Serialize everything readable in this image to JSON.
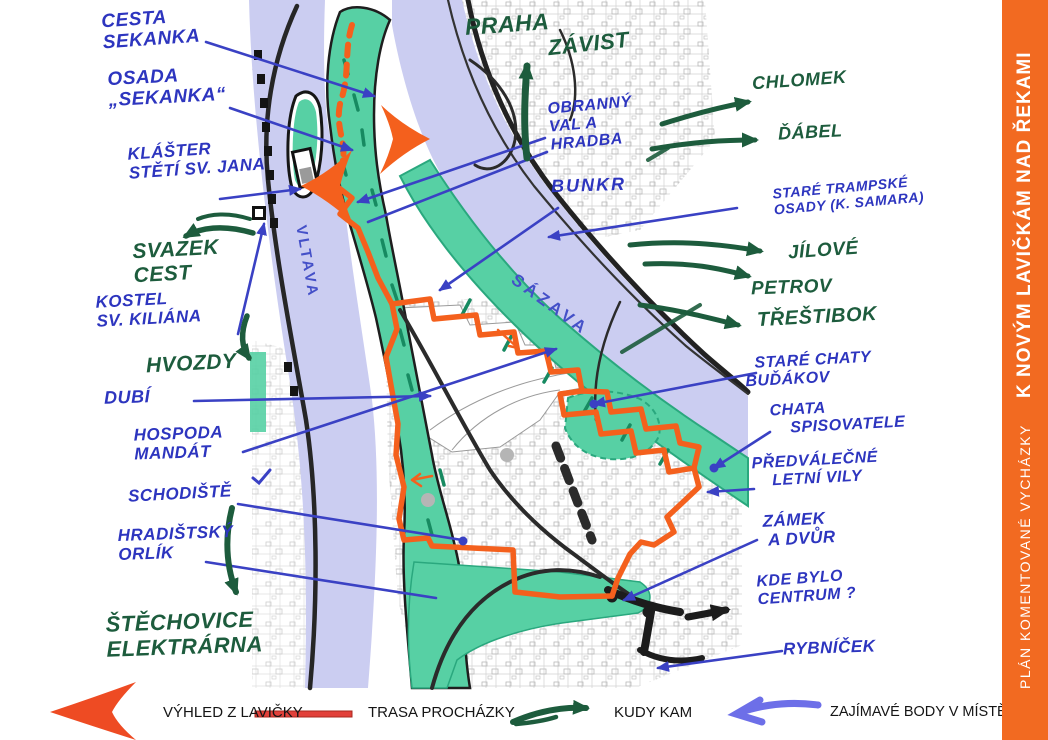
{
  "page": {
    "background": "#ffffff"
  },
  "sidebar": {
    "bg_color": "#f26a21",
    "subtitle": "PLÁN KOMENTOVANÉ VYCHÁZKY",
    "title": "K NOVÝM LAVIČKÁM NAD ŘEKAMI"
  },
  "map": {
    "rivers": {
      "vltava": "VLTAVA",
      "sazava": "SÁZAVA"
    },
    "colors": {
      "river": "#cbcdf1",
      "bank_green": "#57d0a4",
      "bank_dark_green": "#178a61",
      "route_orange": "#f4601d",
      "annotation_blue": "#2d35bf",
      "annotation_green": "#1d5c3d",
      "legend_red": "#e2403a",
      "legend_blue": "#6d6fe8",
      "road_black": "#232323"
    }
  },
  "annotations_blue": {
    "cesta_sekanka": "CESTA\nSEKANKA",
    "osada_sekanka": "OSADA\n„SEKANKA“",
    "klaster": "KLÁŠTER\nSTĚTÍ SV. JANA",
    "kostel": "KOSTEL\nSV. KILIÁNA",
    "dubi": "DUBÍ",
    "hospoda_mandat": "HOSPODA\nMANDÁT",
    "schodiste": "SCHODIŠTĚ",
    "hradistsky_orlik": "HRADIŠTSKÝ\nORLÍK",
    "obranny_val": "OBRANNÝ\nVAL A\nHRADBA",
    "bunkr": "BUNKR",
    "stare_trampske": "STARÉ TRAMPSKÉ\nOSADY (K. SAMARA)",
    "stare_chaty": "  STARÉ CHATY\nBUĎÁKOV",
    "chata_spisovatele": "CHATA\n    SPISOVATELE",
    "predvalecne": "PŘEDVÁLEČNÉ\n    LETNÍ VILY",
    "zamek": "ZÁMEK\n A DVŮR",
    "kde_bylo": "KDE BYLO\nCENTRUM ?",
    "rybnicek": "RYBNÍČEK"
  },
  "annotations_green": {
    "praha": "PRAHA",
    "zavist": "ZÁVIST",
    "chlomek": "CHLOMEK",
    "dabel": "ĎÁBEL",
    "jilove": "JÍLOVÉ",
    "petrov": "PETROV",
    "trestibok": "TŘEŠTIBOK",
    "svazek_cest": "SVAZEK\nCEST",
    "hvozdy": "HVOZDY",
    "stechovice": "ŠTĚCHOVICE\nELEKTRÁRNA"
  },
  "legend": {
    "viewpoint": "VÝHLED Z LAVIČKY",
    "route": "TRASA PROCHÁZKY",
    "direction": "KUDY KAM",
    "points": "ZAJÍMAVÉ BODY V MÍSTĚ"
  }
}
